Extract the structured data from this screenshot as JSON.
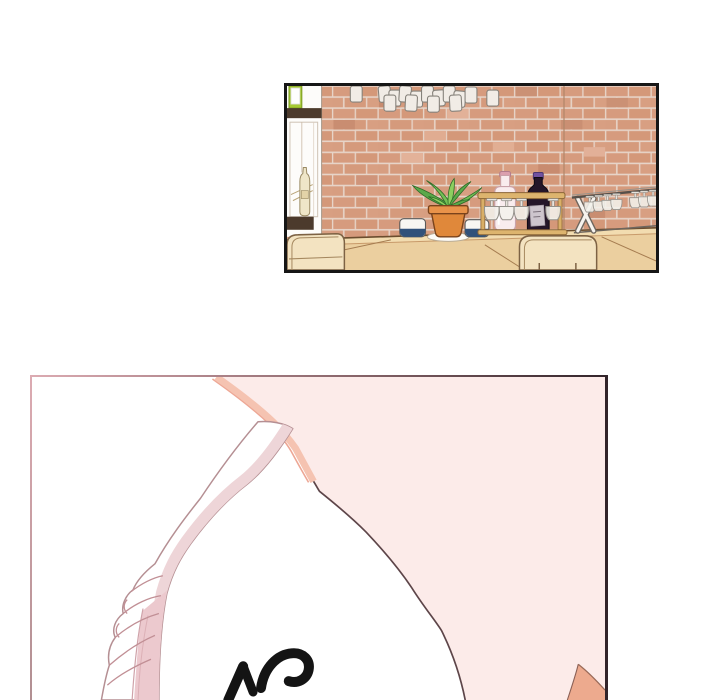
{
  "page": {
    "kind": "webtoon comic page",
    "width": 720,
    "height": 700,
    "background": "#ffffff"
  },
  "panels": [
    {
      "name": "bar-scene",
      "description": "Empty bar interior: salmon brick wall, rows of cups hanging from the ceiling, white wall shelf with a green box and a hanging bottle, bar counter with wooden chairs, two white candle cups with navy bases, a potted green plant in a terracotta pot, a wooden glass rack with hanging stemware, a pale pink bottle, a dark wine bottle with a purple cap, and a white folding stand with hanging wine glasses",
      "border_color": "#161616"
    },
    {
      "name": "shoulder-closeup",
      "description": "Close-up: large soft-pink skin area with a salmon shaded edge, a white shoulder strap with gathered wrinkles running diagonally to the bottom, and partially visible bold black sound-effect lettering clipped by the bottom edge",
      "border_left": "#dcabb2",
      "border_top_gradient": [
        "#dcabb2",
        "#32242a"
      ],
      "border_right": "#32242a"
    }
  ],
  "sfx": {
    "visible_fragment": "tops of two bold brush-letter glyphs, clipped at panel bottom",
    "color": "#141414"
  },
  "palette": {
    "paper": "#ffffff",
    "p1_border": "#161616",
    "pink_skin": "#fcebe9",
    "salmon_trim": "#f5c3b1",
    "arm_shade": "#edaa8e",
    "strap_shade": "#ecc9ce",
    "rosy_outline": "#b58f93",
    "dark_outline": "#5d4549",
    "brick": "#d69b7e",
    "mortar": "#e7d4c8",
    "counter": "#ebcf9f",
    "chair": "#f3e3c1",
    "plant_green": "#69b84f",
    "pot_terracotta": "#e0883a",
    "cup_navy": "#31517a",
    "wine_bottle": "#241629",
    "wine_cap": "#7152a1",
    "pink_bottle": "#f9ecee",
    "rack_wood": "#ddb46e",
    "p2_border_pink": "#dcabb2",
    "p2_border_dark": "#32242a"
  }
}
